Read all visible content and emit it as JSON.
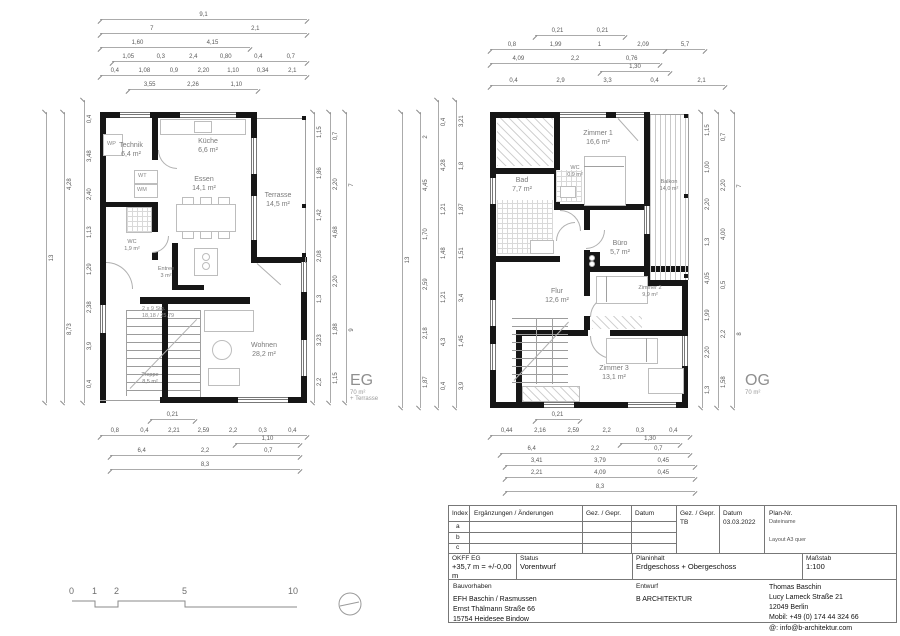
{
  "eg": {
    "title": "EG",
    "area": "70 m²",
    "area_note": "+ Terrasse",
    "rooms": {
      "technik": {
        "name": "Technik",
        "area": "6,4 m²"
      },
      "kueche": {
        "name": "Küche",
        "area": "6,6 m²"
      },
      "essen": {
        "name": "Essen",
        "area": "14,1 m²"
      },
      "terrasse": {
        "name": "Terrasse",
        "area": "14,5 m²"
      },
      "wc": {
        "name": "WC",
        "area": "1,9 m²"
      },
      "entree": {
        "name": "Entree",
        "area": "3 m²"
      },
      "treppe": {
        "name": "Treppe",
        "area": "8,5 m²"
      },
      "wohnen": {
        "name": "Wohnen",
        "area": "28,2 m²"
      }
    },
    "fixtures": {
      "wp": "WP",
      "wt": "WT",
      "wm": "WM"
    },
    "stair_line1": "2 x 9 Stg.",
    "stair_line2": "18,18 / 25,79",
    "dims": {
      "top": [
        [
          "9,1"
        ],
        [
          "7",
          "2,1"
        ],
        [
          "1,60",
          "4,15"
        ],
        [
          "1,05",
          "0,3",
          "2,4",
          "0,80",
          "0,4",
          "0,7"
        ],
        [
          "0,4",
          "1,08",
          "0,9",
          "2,20",
          "1,10",
          "0,34",
          "2,1"
        ],
        [
          "3,55",
          "2,26",
          "1,10"
        ]
      ],
      "bottom": [
        [
          "0,21"
        ],
        [
          "0,8",
          "0,4",
          "2,21",
          "2,59",
          "2,2",
          "0,3",
          "0,4"
        ],
        [
          "1,10"
        ],
        [
          "6,4",
          "2,2",
          "0,7"
        ],
        [
          "8,3"
        ]
      ],
      "left": [
        [
          "13"
        ],
        [
          "4,28",
          "8,73"
        ],
        [
          "0,4",
          "3,48",
          "2,40",
          "1,13",
          "1,29",
          "2,38",
          "3,9",
          "0,4"
        ]
      ],
      "right": [
        [
          "1,15",
          "1,86",
          "1,42",
          "2,08",
          "1,3",
          "3,23",
          "2,2"
        ],
        [
          "0,7",
          "2,20",
          "4,68",
          "2,20",
          "1,88",
          "1,15"
        ],
        [
          "7",
          "9"
        ]
      ]
    }
  },
  "og": {
    "title": "OG",
    "area": "70 m²",
    "rooms": {
      "zimmer1": {
        "name": "Zimmer 1",
        "area": "16,6 m²"
      },
      "wc": {
        "name": "WC",
        "area": "0,9 m²"
      },
      "bad": {
        "name": "Bad",
        "area": "7,7 m²"
      },
      "buero": {
        "name": "Büro",
        "area": "5,7 m²"
      },
      "balkon": {
        "name": "Balkon",
        "area": "14,0 m²"
      },
      "flur": {
        "name": "Flur",
        "area": "12,6 m²"
      },
      "zimmer2": {
        "name": "Zimmer 2",
        "area": "9,9 m²"
      },
      "zimmer3": {
        "name": "Zimmer 3",
        "area": "13,1 m²"
      }
    },
    "dims": {
      "top": [
        [
          "0,21",
          "0,21"
        ],
        [
          "0,8",
          "1,99",
          "1",
          "2,09"
        ],
        [
          "4,09",
          "2,2",
          "0,76"
        ],
        [
          "1,30"
        ],
        [
          "0,4",
          "2,9",
          "3,3",
          "0,4",
          "2,1"
        ],
        [
          "5,7"
        ]
      ],
      "bottom": [
        [
          "0,21"
        ],
        [
          "0,44",
          "2,16",
          "2,59",
          "2,2",
          "0,3",
          "0,4"
        ],
        [
          "1,30"
        ],
        [
          "6,4",
          "2,2",
          "0,7"
        ],
        [
          "3,41",
          "3,79",
          "0,45"
        ],
        [
          "2,21",
          "4,09",
          "0,45"
        ],
        [
          "8,3"
        ]
      ],
      "left": [
        [
          "13"
        ],
        [
          "2",
          "4,45",
          "1,70",
          "2,59",
          "2,18",
          "1,87"
        ],
        [
          "0,4",
          "4,28",
          "1,21",
          "1,48",
          "1,21",
          "4,3",
          "0,4"
        ],
        [
          "3,21",
          "1,8",
          "1,87",
          "1,51",
          "3,4",
          "1,45",
          "3,9"
        ]
      ],
      "right": [
        [
          "1,15",
          "1,00",
          "2,20",
          "1,3",
          "4,05",
          "1,99",
          "2,20",
          "1,3"
        ],
        [
          "0,7",
          "2,20",
          "4,00",
          "0,5",
          "2,2",
          "1,58"
        ],
        [
          "7",
          "8"
        ]
      ]
    }
  },
  "scalebar": {
    "ticks": [
      "0",
      "1",
      "2",
      "5",
      "10"
    ]
  },
  "titleblock": {
    "header": {
      "index": "Index",
      "changes": "Ergänzungen / Änderungen",
      "gez": "Gez. / Gepr.",
      "datum": "Datum",
      "gez2": "Gez. / Gepr.",
      "gez2_value": "TB",
      "datum2": "Datum",
      "datum2_value": "03.03.2022",
      "plan_nr": "Plan-Nr.",
      "plan_file": "Dateiname",
      "plan_layout": "Layout A3 quer"
    },
    "index_rows": [
      "a",
      "b",
      "c"
    ],
    "okff_label": "OKFF EG",
    "okff_value": "+35,7 m = +/-0,00 m",
    "status_label": "Status",
    "status_value": "Vorentwurf",
    "planinhalt_label": "Planinhalt",
    "planinhalt_value": "Erdgeschoss + Obergeschoss",
    "massstab_label": "Maßstab",
    "massstab_value": "1:100",
    "bauvorhaben_label": "Bauvorhaben",
    "bauvorhaben_lines": [
      "EFH Baschin / Rasmussen",
      "Ernst Thälmann Straße 66",
      "15754 Heidesee Bindow"
    ],
    "entwurf_label": "Entwurf",
    "entwurf_value": "B ARCHITEKTUR",
    "architect_lines": [
      "Thomas Baschin",
      "Lucy Lameck Straße 21",
      "12049 Berlin",
      "Mobil: +49 (0) 174 44 324 66",
      "@: info@b-architektur.com"
    ]
  }
}
